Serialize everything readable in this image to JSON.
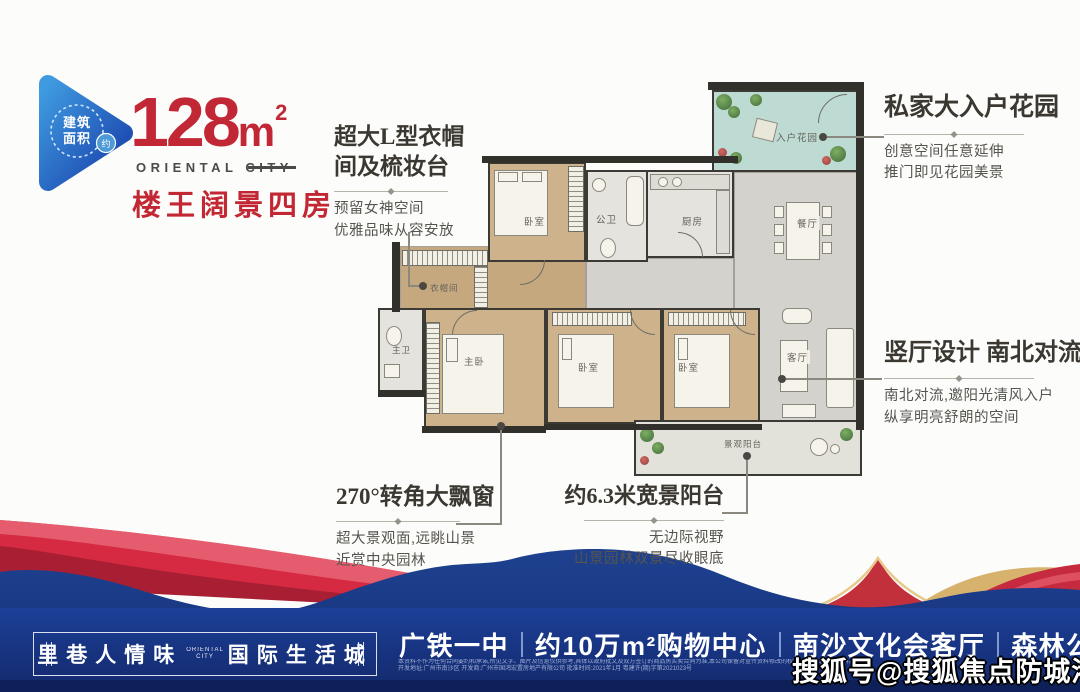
{
  "header": {
    "badge_circle_text_1": "建筑",
    "badge_circle_text_2": "面积",
    "badge_approx": "约",
    "area_number": "128",
    "area_unit": "m",
    "area_sup": "2",
    "subtitle_en": "ORIENTAL CITY",
    "subtitle_cn": "楼王阔景四房"
  },
  "annotations": {
    "closet": {
      "title": "超大L型衣帽间及梳妆台",
      "line1": "预留女神空间",
      "line2": "优雅品味从容安放"
    },
    "garden": {
      "title": "私家大入户花园",
      "line1": "创意空间任意延伸",
      "line2": "推门即见花园美景"
    },
    "living": {
      "title": "竖厅设计 南北对流",
      "line1": "南北对流,邀阳光清风入户",
      "line2": "纵享明亮舒朗的空间"
    },
    "baywindow": {
      "title": "270°转角大飘窗",
      "line1": "超大景观面,远眺山景",
      "line2": "近赏中央园林"
    },
    "balcony": {
      "title": "约6.3米宽景阳台",
      "line1": "无边际视野",
      "line2": "山景园林双景尽收眼底"
    }
  },
  "floorplan": {
    "rooms": {
      "bedroom_top": "卧室",
      "bath_public": "公卫",
      "kitchen": "厨房",
      "entry_garden": "入户花园",
      "dining": "餐厅",
      "living": "客厅",
      "closet": "衣帽间",
      "master_bath": "主卫",
      "master_bed": "主卧",
      "bedroom_mid": "卧室",
      "bedroom_right": "卧室",
      "balcony": "景观阳台"
    }
  },
  "footer": {
    "slogan_left": "里巷人情味",
    "slogan_center_1": "ORIENTAL",
    "slogan_center_2": "CITY",
    "slogan_right": "国际生活城",
    "amenities": [
      "广铁一中",
      "约10万m²购物中心",
      "南沙文化会客厅",
      "森林公园头排"
    ],
    "disclaimer_line1": "本资料不作为任何合同要约和承诺,所见文字、图片及信息仅供参考,具体以政府批文及双方签订的商品房买卖合同为准,本公司保留对宣传资料修改的权利,敬请留意最新资料。",
    "disclaimer_line2": "开发地址:广州市南沙区 开发商:广州市国鸿宏置房地产有限公司 批准时间:2021年1月 粤建许(期)字第2021023号",
    "watermark": "搜狐号@搜狐焦点防城港站"
  },
  "colors": {
    "accent_red": "#c22736",
    "navy_band": "#1c3f97",
    "logo_blue": "#1f55c0",
    "garden_teal": "#bedbd3",
    "wood_floor": "#cdb28b",
    "gold": "#d6b26c"
  }
}
